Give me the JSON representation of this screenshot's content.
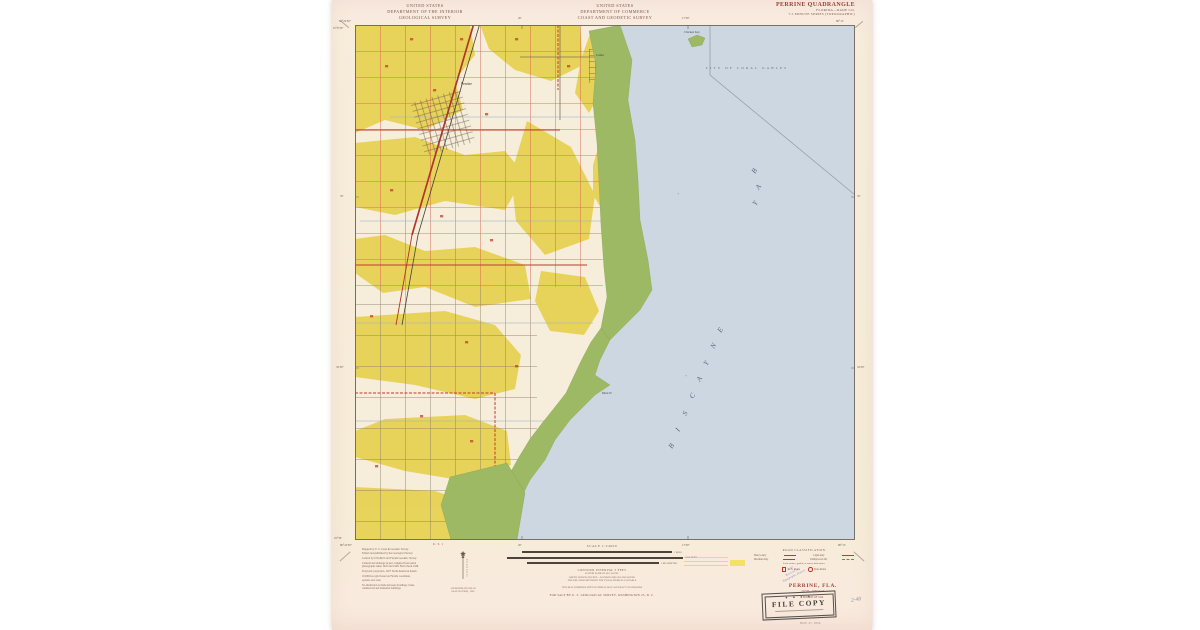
{
  "colors": {
    "paper": "#f8ecdc",
    "water": "#ccd7e2",
    "land_yellow": "#e8d254",
    "mangrove": "#9db964",
    "road_red": "#c8584a",
    "accent_maroon": "#9a4036",
    "stamp_purple": "#8577c9"
  },
  "header": {
    "usgs": [
      "UNITED STATES",
      "DEPARTMENT OF THE INTERIOR",
      "GEOLOGICAL SURVEY"
    ],
    "uscgs": [
      "UNITED STATES",
      "DEPARTMENT OF COMMERCE",
      "COAST AND GEODETIC SURVEY"
    ],
    "quad": {
      "title": "PERRINE QUADRANGLE",
      "sub1": "FLORIDA—DADE CO.",
      "sub2": "7.5 MINUTE SERIES (TOPOGRAPHIC)"
    }
  },
  "map": {
    "labels": {
      "perrine": "Perrine",
      "cutler": "Cutler",
      "chicken_key": "Chicken Key",
      "black_pt": "Black Pt",
      "coral_gables": "CITY OF CORAL GABLES",
      "plus": "+"
    },
    "biscayne_letters": [
      "B",
      "I",
      "S",
      "C",
      "A",
      "Y",
      "N",
      "E"
    ],
    "bay_letters": [
      "B",
      "A",
      "Y"
    ],
    "coords": {
      "tl_lon": "80°22'30\"",
      "tr_lon": "80°15'",
      "lat_top": "25°37'30\"",
      "lat_bottom": "25°30'",
      "tick_top_1": "20'",
      "tick_top_2": "17'30\"",
      "tick_side_1": "35'",
      "tick_side_2": "32'30\"",
      "us1": "U. S. 1"
    }
  },
  "footer": {
    "credits": [
      "Mapped by U. S. Coast & Geodetic Survey",
      "Edited and published by the Geological Survey",
      "Control by USC&GS and Florida Geodetic Survey",
      "Cultural and drainage in part compiled from aerial",
      "photographs taken 1945 and 1948. Field check 1948",
      "Polyconic projection. 1927 North American datum",
      "10,000-foot grid based on Florida coordinate",
      "system, east zone",
      "No distinction is made between dwellings, barns,",
      "commercial and industrial buildings"
    ],
    "declination": [
      "APPROXIMATE MEAN",
      "DECLINATION, 1949"
    ],
    "scale": {
      "label": "SCALE 1:24000",
      "mile": "1 MILE",
      "feet": "7000 FEET",
      "km": "1 KILOMETER",
      "c1": "CONTOUR INTERVAL 5 FEET",
      "c2": "DATUM IS MEAN SEA LEVEL",
      "c3": "DEPTH CURVES IN FEET—DATUM IS MEAN LOW WATER",
      "c4": "THE RELATION BETWEEN THE TWO DATUMS IS VARIABLE",
      "accuracy": "THIS MAP COMPLIES WITH NATIONAL MAP ACCURACY STANDARDS",
      "sale": "FOR SALE BY U. S. GEOLOGICAL SURVEY, WASHINGTON 25, D. C."
    },
    "road_class": {
      "title": "ROAD CLASSIFICATION",
      "heavy": "Heavy-duty",
      "medium": "Medium-duty",
      "light": "Light-duty",
      "unimproved": "Unimproved dirt",
      "loose": "Loose surface, graded, or narrow hard surface",
      "us_route": "U. S. Route",
      "state_route": "State Route"
    },
    "title_block": {
      "name": "PERRINE, FLA.",
      "code": "N2530—W8015/7.5",
      "edition": "EDITION OF 1949"
    },
    "stamps": {
      "stars": "★ ★ ★ ★",
      "file_copy": "FILE COPY",
      "purple": [
        "MAP",
        "Received by",
        "Topographic Branch"
      ],
      "date": "NOV 27 1950",
      "pencil": "2-48"
    }
  }
}
